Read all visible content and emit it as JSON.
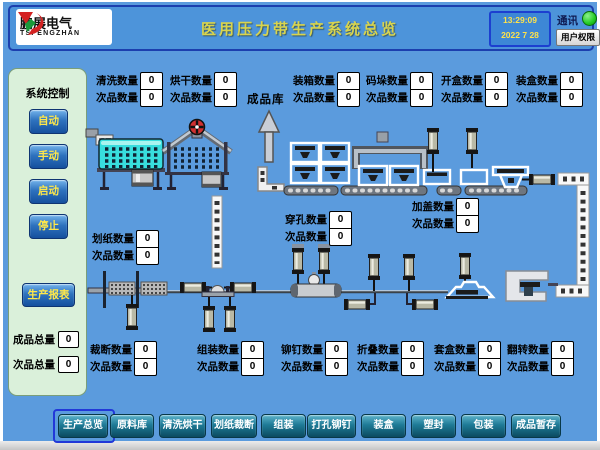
{
  "header": {
    "logo": {
      "company_cn": "鹏展电气",
      "company_en": "TSPENGZHAN"
    },
    "title": "医用压力带生产系统总览",
    "clock": {
      "time": "13:29:09",
      "date": "2022  7  28"
    },
    "comm_label": "通讯",
    "comm_status_color": "#23CC23",
    "user_button": "用户权限"
  },
  "sidebar": {
    "title": "系统控制",
    "buttons": [
      {
        "label": "自动"
      },
      {
        "label": "手动"
      },
      {
        "label": "启动"
      },
      {
        "label": "停止"
      }
    ],
    "report_button": "生产报表",
    "totals": [
      {
        "label": "成品总量",
        "value": "0"
      },
      {
        "label": "次品总量",
        "value": "0"
      }
    ]
  },
  "plant": {
    "warehouse_label": "成品库",
    "counters": [
      {
        "id": "washing",
        "label": "清洗数量",
        "value": "0",
        "reject_label": "次品数量",
        "reject_value": "0"
      },
      {
        "id": "drying",
        "label": "烘干数量",
        "value": "0",
        "reject_label": "次品数量",
        "reject_value": "0"
      },
      {
        "id": "boxing",
        "label": "装箱数量",
        "value": "0",
        "reject_label": "次品数量",
        "reject_value": "0"
      },
      {
        "id": "palletizing",
        "label": "码垛数量",
        "value": "0",
        "reject_label": "次品数量",
        "reject_value": "0"
      },
      {
        "id": "box-opening",
        "label": "开盒数量",
        "value": "0",
        "reject_label": "次品数量",
        "reject_value": "0"
      },
      {
        "id": "box-filling",
        "label": "装盒数量",
        "value": "0",
        "reject_label": "次品数量",
        "reject_value": "0"
      },
      {
        "id": "paper-scoring",
        "label": "划纸数量",
        "value": "0",
        "reject_label": "次品数量",
        "reject_value": "0"
      },
      {
        "id": "punching",
        "label": "穿孔数量",
        "value": "0",
        "reject_label": "次品数量",
        "reject_value": "0"
      },
      {
        "id": "capping",
        "label": "加盖数量",
        "value": "0",
        "reject_label": "次品数量",
        "reject_value": "0"
      },
      {
        "id": "cutting",
        "label": "裁断数量",
        "value": "0",
        "reject_label": "次品数量",
        "reject_value": "0"
      },
      {
        "id": "assembly",
        "label": "组装数量",
        "value": "0",
        "reject_label": "次品数量",
        "reject_value": "0"
      },
      {
        "id": "riveting",
        "label": "铆钉数量",
        "value": "0",
        "reject_label": "次品数量",
        "reject_value": "0"
      },
      {
        "id": "folding",
        "label": "折叠数量",
        "value": "0",
        "reject_label": "次品数量",
        "reject_value": "0"
      },
      {
        "id": "casing",
        "label": "套盒数量",
        "value": "0",
        "reject_label": "次品数量",
        "reject_value": "0"
      },
      {
        "id": "flipping",
        "label": "翻转数量",
        "value": "0",
        "reject_label": "次品数量",
        "reject_value": "0"
      }
    ]
  },
  "nav": {
    "tabs": [
      {
        "label": "生产总览",
        "active": true
      },
      {
        "label": "原料库",
        "active": false
      },
      {
        "label": "清洗烘干",
        "active": false
      },
      {
        "label": "划纸裁断",
        "active": false
      },
      {
        "label": "组装",
        "active": false
      },
      {
        "label": "打孔铆钉",
        "active": false
      },
      {
        "label": "装盒",
        "active": false
      },
      {
        "label": "塑封",
        "active": false
      },
      {
        "label": "包装",
        "active": false
      },
      {
        "label": "成品暂存",
        "active": false
      }
    ]
  },
  "colors": {
    "background": "#5B9BDD",
    "header_bar": "#4D94DA",
    "title_text": "#D8D44E",
    "clock_text": "#FFE34A",
    "sidebar_bg": "#DAF0DA",
    "button_text_yellow": "#FFE84A",
    "nav_button_teal": "#1E7A96",
    "status_green": "#23CC23",
    "tank_cyan": "#38DEDE"
  }
}
